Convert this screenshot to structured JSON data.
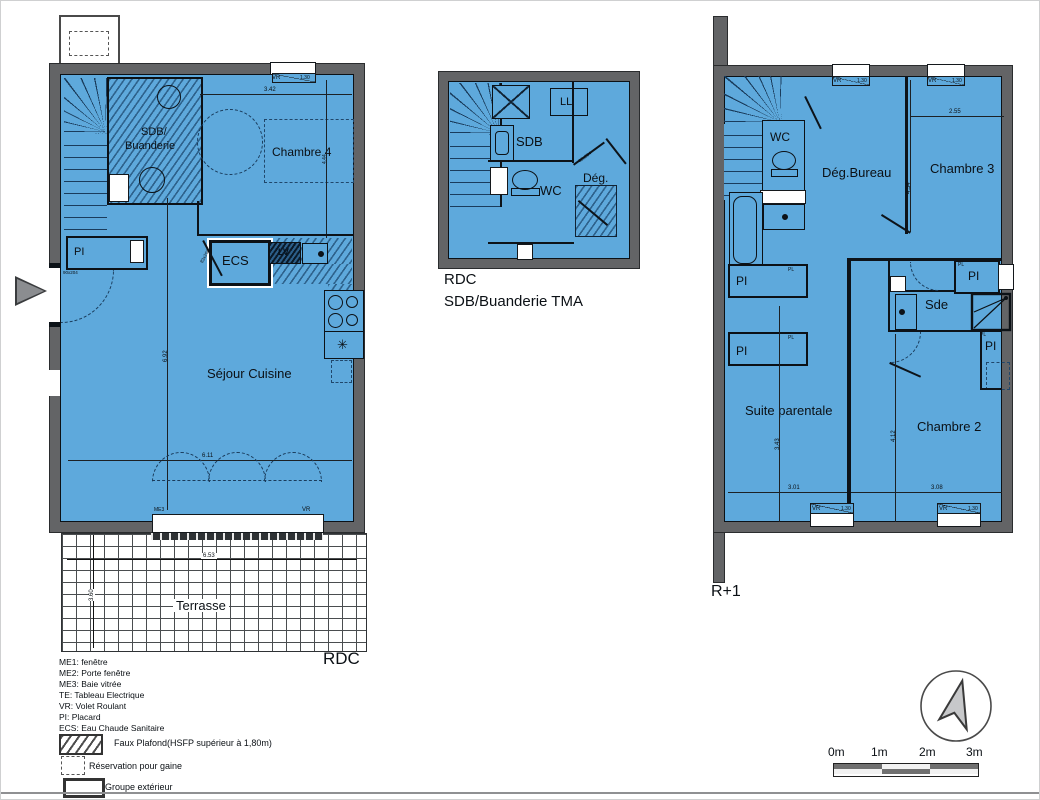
{
  "colors": {
    "plan-fill": "#5ea9dc",
    "wall": "#636466"
  },
  "rdc": {
    "label": "RDC",
    "sdb_line1": "SDB/",
    "sdb_line2": "Buanderie",
    "chambre4": "Chambre 4",
    "pi": "PI",
    "ecs": "ECS",
    "lv": "LV",
    "sejour": "Séjour Cuisine",
    "terrasse": "Terrasse",
    "me3": "ME3",
    "vr": "VR",
    "stove_symbol": "✳",
    "dims": {
      "w342": "3.42",
      "w130": "1.30",
      "h444": "4.44",
      "h692": "6.92",
      "w611": "6.11",
      "w653": "6.53",
      "h360": "3.60"
    },
    "door_entry": "90x204",
    "door_std": "83x204"
  },
  "tma": {
    "caption1": "RDC",
    "caption2": "SDB/Buanderie TMA",
    "ll": "LL",
    "sdb": "SDB",
    "wc": "WC",
    "deg": "Dég.",
    "door_std": "83x204"
  },
  "r1": {
    "label": "R+1",
    "wc": "WC",
    "deg_bureau": "Dég.Bureau",
    "chambre3": "Chambre 3",
    "pi": "PI",
    "pl": "PL",
    "sde": "Sde",
    "suite": "Suite parentale",
    "chambre2": "Chambre 2",
    "vr": "VR",
    "dims": {
      "w255": "2.55",
      "h454": "4.54",
      "h343": "3.43",
      "w301": "3.01",
      "h412": "4.12",
      "w308": "3.08",
      "w130": "1.30"
    },
    "door_std": "83x204"
  },
  "legend": {
    "lines": [
      "ME1: fenêtre",
      "ME2: Porte fenêtre",
      "ME3: Baie vitrée",
      "TE: Tableau Electrique",
      "VR: Volet Roulant",
      "PI: Placard",
      "ECS: Eau Chaude Sanitaire"
    ],
    "faux_plafond": "Faux Plafond(HSFP supérieur à 1,80m)",
    "reservation": "Réservation pour gaine",
    "groupe": "Groupe extérieur"
  },
  "scalebar": {
    "labels": [
      "0m",
      "1m",
      "2m",
      "3m"
    ]
  }
}
